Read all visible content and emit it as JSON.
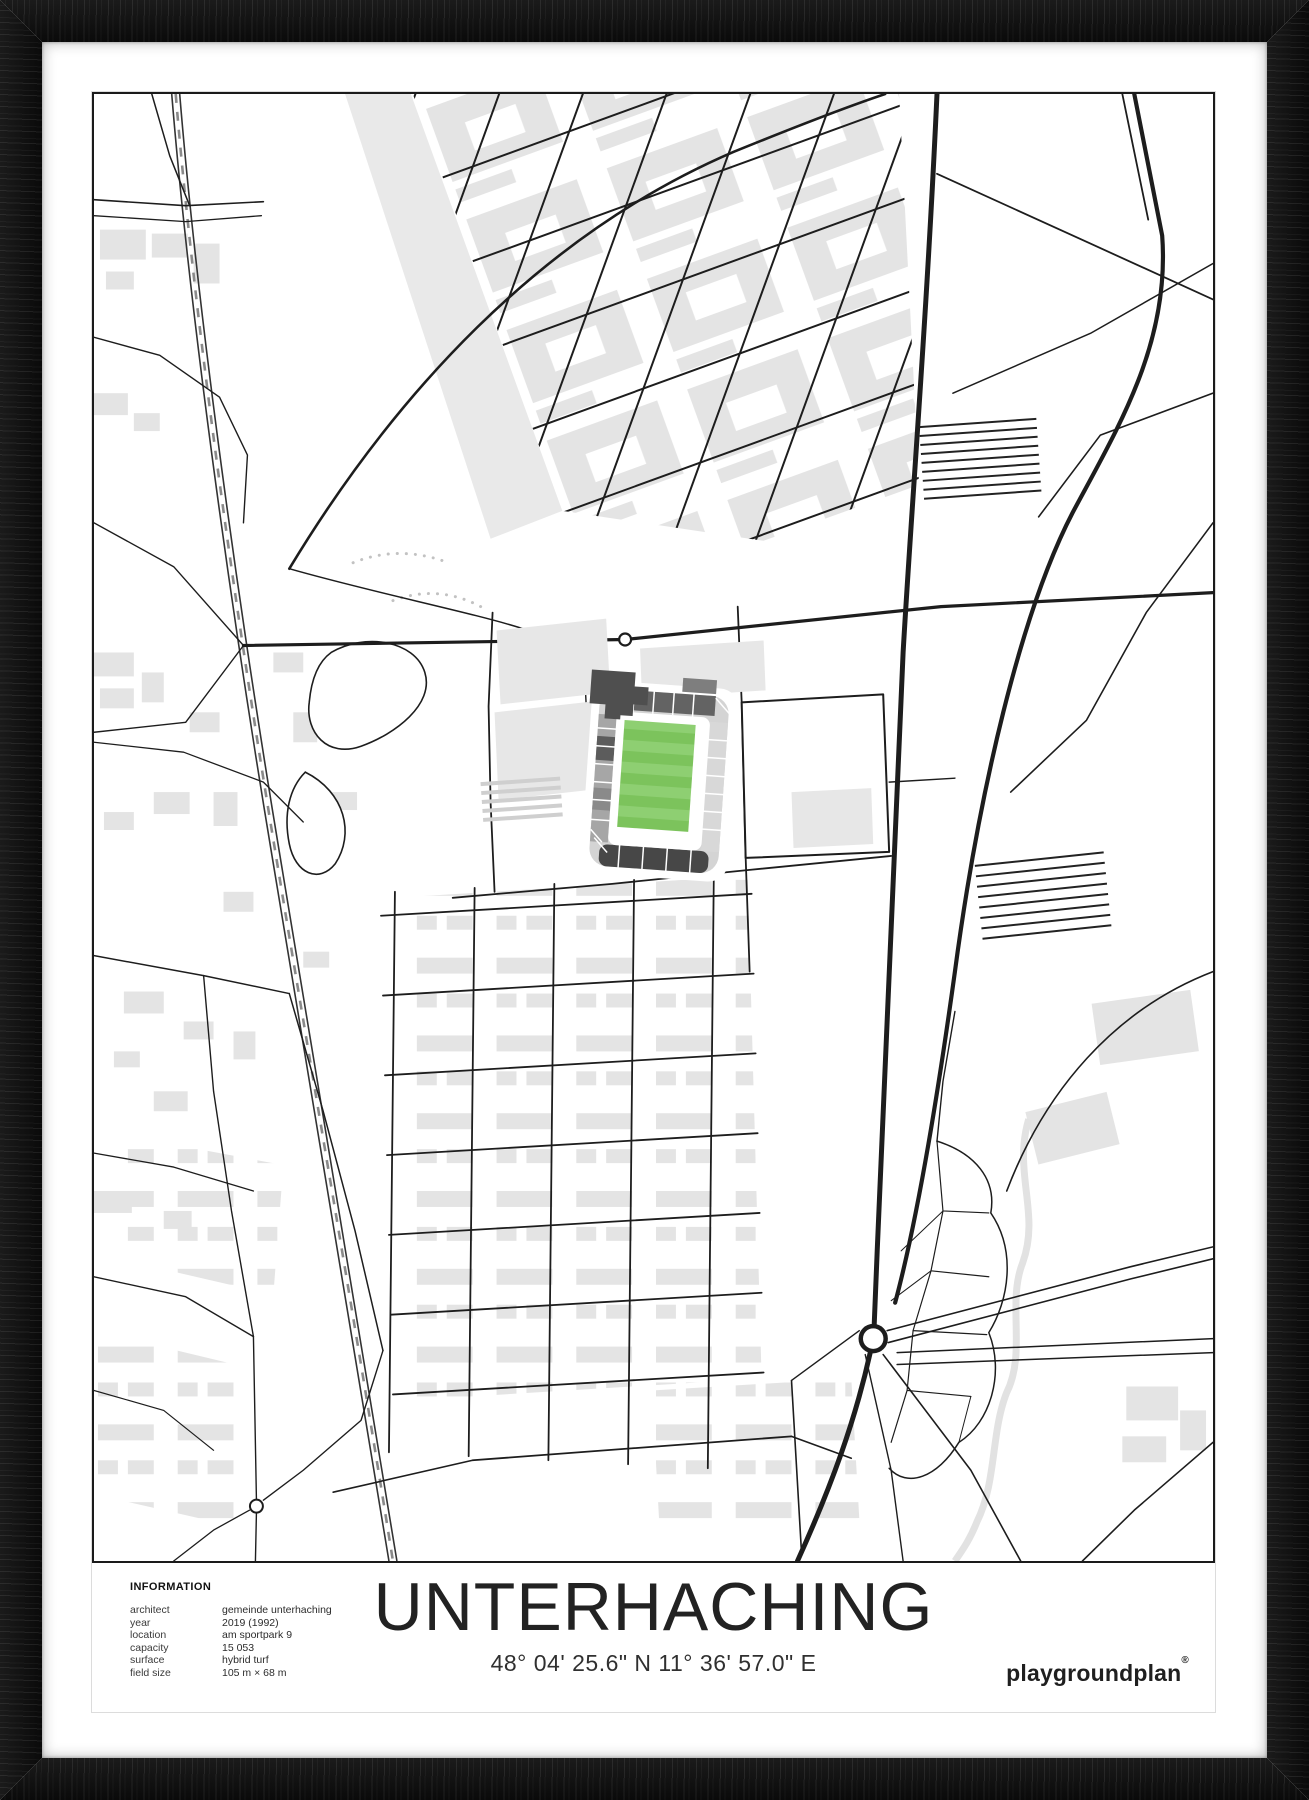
{
  "poster": {
    "title": "UNTERHACHING",
    "coordinates": "48° 04' 25.6\" N 11° 36' 57.0\" E",
    "brand": "playgroundplan",
    "brand_mark": "®",
    "info": {
      "heading": "INFORMATION",
      "rows": [
        {
          "label": "architect",
          "value": "gemeinde unterhaching"
        },
        {
          "label": "year",
          "value": "2019 (1992)"
        },
        {
          "label": "location",
          "value": "am sportpark 9"
        },
        {
          "label": "capacity",
          "value": "15 053"
        },
        {
          "label": "surface",
          "value": "hybrid turf"
        },
        {
          "label": "field size",
          "value": "105 m × 68 m"
        }
      ]
    },
    "map": {
      "type": "street-map",
      "highlight": "stadium-pitch"
    },
    "colors": {
      "frame_black": "#121212",
      "paper_white": "#ffffff",
      "road_black": "#1d1d1d",
      "building_gray": "#e4e4e4",
      "pitch_green": "#7cc35c",
      "pitch_green_light": "#8ecf72",
      "stand_dark_gray": "#4f4f4f",
      "stand_light_gray": "#d8d8d8"
    }
  }
}
